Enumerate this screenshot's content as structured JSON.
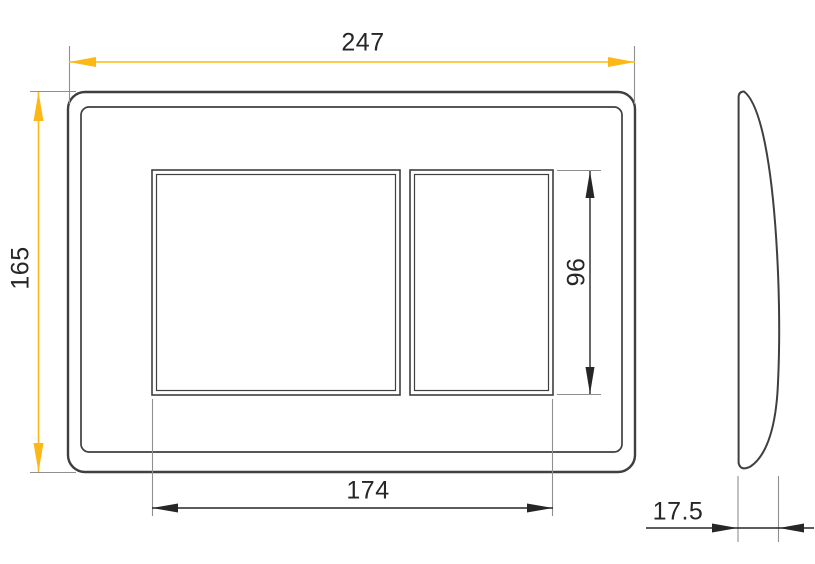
{
  "drawing": {
    "kind": "dimensioned technical drawing, front view and side profile of a two-button rectangular plate",
    "dimensions": {
      "overall_width": {
        "value": "247"
      },
      "overall_height": {
        "value": "165"
      },
      "button_area_width": {
        "value": "174"
      },
      "button_area_height": {
        "value": "96"
      },
      "thickness": {
        "value": "17.5"
      }
    },
    "colors": {
      "background": "#ffffff",
      "dimension_accent_yellow": "#fbb817",
      "dimension_dark": "#262626",
      "outline_dark": "#3f3f3f",
      "extension_line_gray": "#8f8f8f",
      "label_text": "#262626"
    }
  }
}
